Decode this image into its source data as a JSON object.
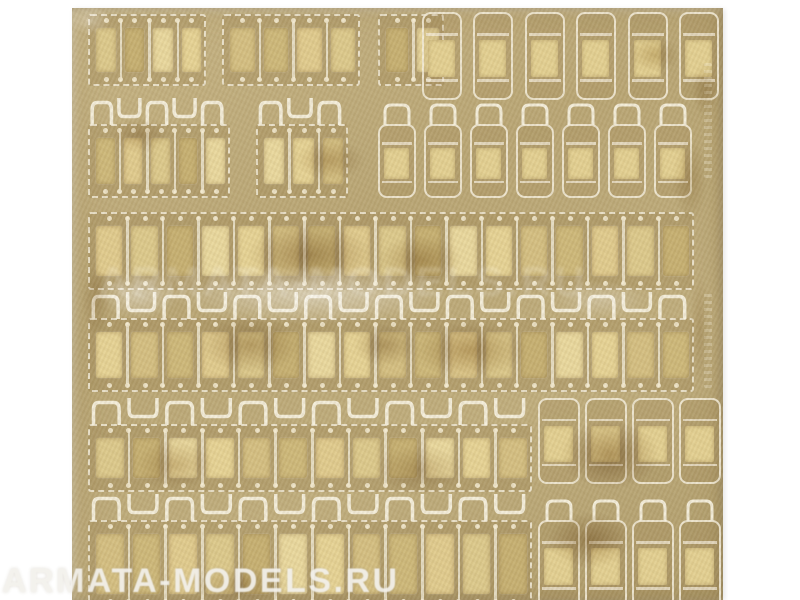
{
  "watermark": {
    "text": "ARMATA-MODELS.RU",
    "color": "#f3f1ec"
  },
  "ghost_watermark": {
    "text": "ARMATA-MODELS.RU"
  },
  "photo": {
    "description": "Photo-etched brass fret with rows of model tank track links, tarnished gold metal on white background",
    "sheet": {
      "x": 72,
      "y": 8,
      "width": 651,
      "height": 592
    },
    "colors": {
      "background": "#ffffff",
      "brass_light": "#c6b485",
      "brass_mid": "#b9a776",
      "brass_dark": "#ab9868",
      "etch": "#f6f0df",
      "dot": "#f3ead0",
      "pads": [
        "#dcc98c",
        "#cdb87a",
        "#e6d395",
        "#c6b072",
        "#e0cb8e",
        "#d4bf82",
        "#e9d89e"
      ],
      "single_pad": "#e3d092"
    },
    "strips": [
      {
        "x": 16,
        "y": 6,
        "w": 118,
        "h": 72,
        "links": 4,
        "bells": false
      },
      {
        "x": 150,
        "y": 6,
        "w": 138,
        "h": 72,
        "links": 4,
        "bells": false
      },
      {
        "x": 306,
        "y": 6,
        "w": 66,
        "h": 72,
        "links": 2,
        "bells": false
      },
      {
        "x": 16,
        "y": 116,
        "w": 142,
        "h": 74,
        "links": 5,
        "bells": true
      },
      {
        "x": 184,
        "y": 116,
        "w": 92,
        "h": 74,
        "links": 3,
        "bells": true
      },
      {
        "x": 16,
        "y": 204,
        "w": 606,
        "h": 78,
        "links": 17,
        "bells": false
      },
      {
        "x": 16,
        "y": 310,
        "w": 606,
        "h": 74,
        "links": 17,
        "bells": true
      },
      {
        "x": 16,
        "y": 416,
        "w": 444,
        "h": 68,
        "links": 12,
        "bells": true
      },
      {
        "x": 16,
        "y": 512,
        "w": 444,
        "h": 88,
        "links": 12,
        "bells": true
      }
    ],
    "singles": [
      {
        "x": 350,
        "y": 4,
        "w": 40,
        "h": 88,
        "bell": false
      },
      {
        "x": 401,
        "y": 4,
        "w": 40,
        "h": 88,
        "bell": false
      },
      {
        "x": 453,
        "y": 4,
        "w": 40,
        "h": 88,
        "bell": false
      },
      {
        "x": 504,
        "y": 4,
        "w": 40,
        "h": 88,
        "bell": false
      },
      {
        "x": 556,
        "y": 4,
        "w": 40,
        "h": 88,
        "bell": false
      },
      {
        "x": 607,
        "y": 4,
        "w": 40,
        "h": 88,
        "bell": false
      },
      {
        "x": 306,
        "y": 116,
        "w": 38,
        "h": 74,
        "bell": true
      },
      {
        "x": 352,
        "y": 116,
        "w": 38,
        "h": 74,
        "bell": true
      },
      {
        "x": 398,
        "y": 116,
        "w": 38,
        "h": 74,
        "bell": true
      },
      {
        "x": 444,
        "y": 116,
        "w": 38,
        "h": 74,
        "bell": true
      },
      {
        "x": 490,
        "y": 116,
        "w": 38,
        "h": 74,
        "bell": true
      },
      {
        "x": 536,
        "y": 116,
        "w": 38,
        "h": 74,
        "bell": true
      },
      {
        "x": 582,
        "y": 116,
        "w": 38,
        "h": 74,
        "bell": true
      },
      {
        "x": 466,
        "y": 390,
        "w": 42,
        "h": 86,
        "bell": false
      },
      {
        "x": 513,
        "y": 390,
        "w": 42,
        "h": 86,
        "bell": false
      },
      {
        "x": 560,
        "y": 390,
        "w": 42,
        "h": 86,
        "bell": false
      },
      {
        "x": 607,
        "y": 390,
        "w": 42,
        "h": 86,
        "bell": false
      },
      {
        "x": 466,
        "y": 512,
        "w": 42,
        "h": 88,
        "bell": true
      },
      {
        "x": 513,
        "y": 512,
        "w": 42,
        "h": 88,
        "bell": true
      },
      {
        "x": 560,
        "y": 512,
        "w": 42,
        "h": 88,
        "bell": true
      },
      {
        "x": 607,
        "y": 512,
        "w": 42,
        "h": 88,
        "bell": true
      }
    ],
    "stains": [
      {
        "x": 238,
        "y": 247,
        "rx": 90,
        "ry": 45,
        "c": "#8a6a38",
        "a": 0.45
      },
      {
        "x": 348,
        "y": 252,
        "rx": 60,
        "ry": 35,
        "c": "#96763f",
        "a": 0.4
      },
      {
        "x": 313,
        "y": 337,
        "rx": 45,
        "ry": 30,
        "c": "#7d5e30",
        "a": 0.35
      },
      {
        "x": 178,
        "y": 337,
        "rx": 70,
        "ry": 40,
        "c": "#8a6a38",
        "a": 0.4
      },
      {
        "x": 398,
        "y": 342,
        "rx": 80,
        "ry": 40,
        "c": "#96763f",
        "a": 0.45
      },
      {
        "x": 103,
        "y": 457,
        "rx": 55,
        "ry": 35,
        "c": "#9a7a45",
        "a": 0.35
      },
      {
        "x": 348,
        "y": 462,
        "rx": 65,
        "ry": 35,
        "c": "#8a6a38",
        "a": 0.3
      },
      {
        "x": 538,
        "y": 447,
        "rx": 70,
        "ry": 50,
        "c": "#8a6a38",
        "a": 0.5
      },
      {
        "x": 518,
        "y": 532,
        "rx": 60,
        "ry": 40,
        "c": "#96763f",
        "a": 0.45
      },
      {
        "x": 258,
        "y": 152,
        "rx": 50,
        "ry": 28,
        "c": "#9a7a45",
        "a": 0.35
      },
      {
        "x": 68,
        "y": 127,
        "rx": 40,
        "ry": 25,
        "c": "#9a7a45",
        "a": 0.3
      },
      {
        "x": 618,
        "y": 172,
        "rx": 25,
        "ry": 60,
        "c": "#a08448",
        "a": 0.3
      },
      {
        "x": 633,
        "y": 82,
        "rx": 18,
        "ry": 40,
        "c": "#a08448",
        "a": 0.3
      },
      {
        "x": 168,
        "y": 577,
        "rx": 70,
        "ry": 25,
        "c": "#8a6a38",
        "a": 0.35
      },
      {
        "x": 24,
        "y": 292,
        "rx": 20,
        "ry": 50,
        "c": "#9a7a45",
        "a": 0.3
      },
      {
        "x": 583,
        "y": 47,
        "rx": 35,
        "ry": 25,
        "c": "#a08448",
        "a": 0.35
      },
      {
        "x": 628,
        "y": 322,
        "rx": 15,
        "ry": 80,
        "c": "#a08448",
        "a": 0.25
      }
    ],
    "glare": [
      {
        "x": 238,
        "y": 287,
        "rx": 200,
        "ry": 42,
        "c": "#ffffff",
        "a": 0.45
      },
      {
        "x": 68,
        "y": 287,
        "rx": 55,
        "ry": 35,
        "c": "#ffffff",
        "a": 0.4
      },
      {
        "x": 528,
        "y": 292,
        "rx": 70,
        "ry": 28,
        "c": "#ffffff",
        "a": 0.25
      },
      {
        "x": 18,
        "y": 12,
        "rx": 30,
        "ry": 20,
        "c": "#ffffff",
        "a": 0.3
      }
    ],
    "markings": [
      {
        "x": 632,
        "y": 55,
        "w": 8,
        "h": 115
      },
      {
        "x": 632,
        "y": 285,
        "w": 8,
        "h": 95
      }
    ]
  }
}
